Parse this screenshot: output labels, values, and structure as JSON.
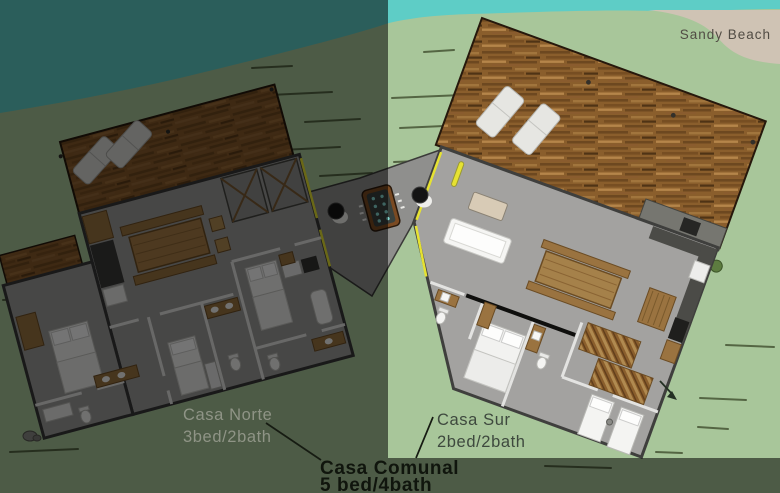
{
  "scene": {
    "environment": {
      "beach_label": "Sandy Beach"
    },
    "houses": {
      "casa_norte": {
        "name": "Casa Norte",
        "specs": "3bed/2bath"
      },
      "casa_sur": {
        "name": "Casa Sur",
        "specs": "2bed/2bath"
      },
      "casa_comunal": {
        "name": "Casa Comunal",
        "specs": "5 bed/4bath"
      }
    },
    "features": {
      "hot_tub": "hot-tub",
      "grills": "kettle-grill",
      "loungers": "sun-lounger",
      "decks": "wood-deck",
      "walkway": "connecting-walkway"
    },
    "colors": {
      "water": "#5ecdc6",
      "grass": "#a8c69a",
      "sand": "#cfc3b4",
      "deck_wood": "#875a2b",
      "interior_floor": "#a3a2a0",
      "wall_outline": "#383838",
      "partition": "#e3e3e1",
      "accent_yellow": "#e6e232",
      "hot_tub_jets": "#86d8d2",
      "shadow_overlay": "rgba(0,0,0,0.54)",
      "label_on_dark": "#8f9486",
      "label_on_light": "#3e493e",
      "label_bold": "#10150d"
    }
  }
}
